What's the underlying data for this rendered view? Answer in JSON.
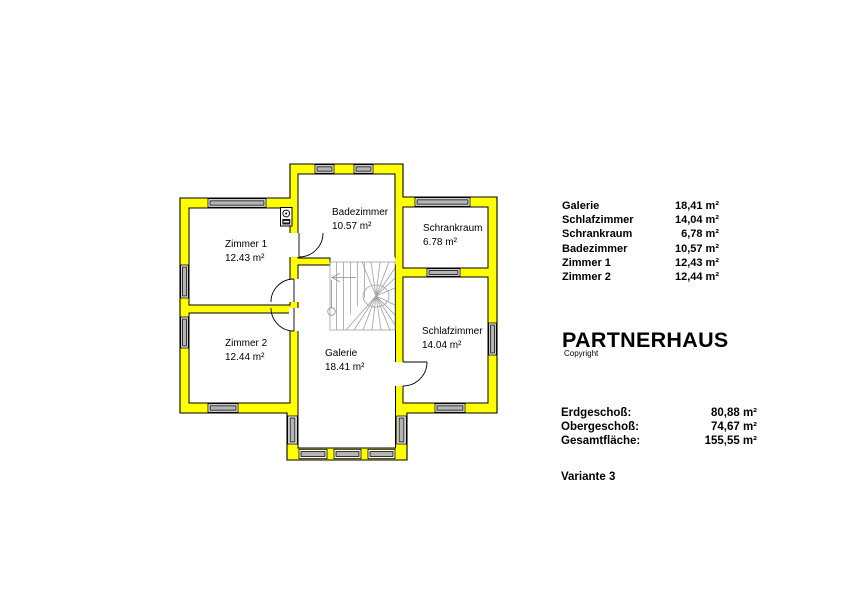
{
  "plan": {
    "wall_color": "#ffff00",
    "stair_color": "#a0a0a0",
    "window_fill": "#b4b4b4",
    "rooms": [
      {
        "name": "Zimmer 1",
        "area": "12.43 m²"
      },
      {
        "name": "Zimmer 2",
        "area": "12.44 m²"
      },
      {
        "name": "Badezimmer",
        "area": "10.57 m²"
      },
      {
        "name": "Schrankraum",
        "area": "6.78 m²"
      },
      {
        "name": "Schlafzimmer",
        "area": "14.04 m²"
      },
      {
        "name": "Galerie",
        "area": "18.41 m²"
      }
    ]
  },
  "legend": {
    "rows": [
      {
        "label": "Galerie",
        "value": "18,41 m²"
      },
      {
        "label": "Schlafzimmer",
        "value": "14,04 m²"
      },
      {
        "label": "Schrankraum",
        "value": "6,78 m²"
      },
      {
        "label": "Badezimmer",
        "value": "10,57 m²"
      },
      {
        "label": "Zimmer 1",
        "value": "12,43 m²"
      },
      {
        "label": "Zimmer 2",
        "value": "12,44 m²"
      }
    ]
  },
  "branding": {
    "title": "PARTNERHAUS",
    "copyright": "Copyright"
  },
  "totals": {
    "rows": [
      {
        "label": "Erdgeschoß:",
        "value": "80,88 m²"
      },
      {
        "label": "Obergeschoß:",
        "value": "74,67 m²"
      },
      {
        "label": "Gesamtfläche:",
        "value": "155,55 m²"
      }
    ]
  },
  "variant": "Variante 3"
}
